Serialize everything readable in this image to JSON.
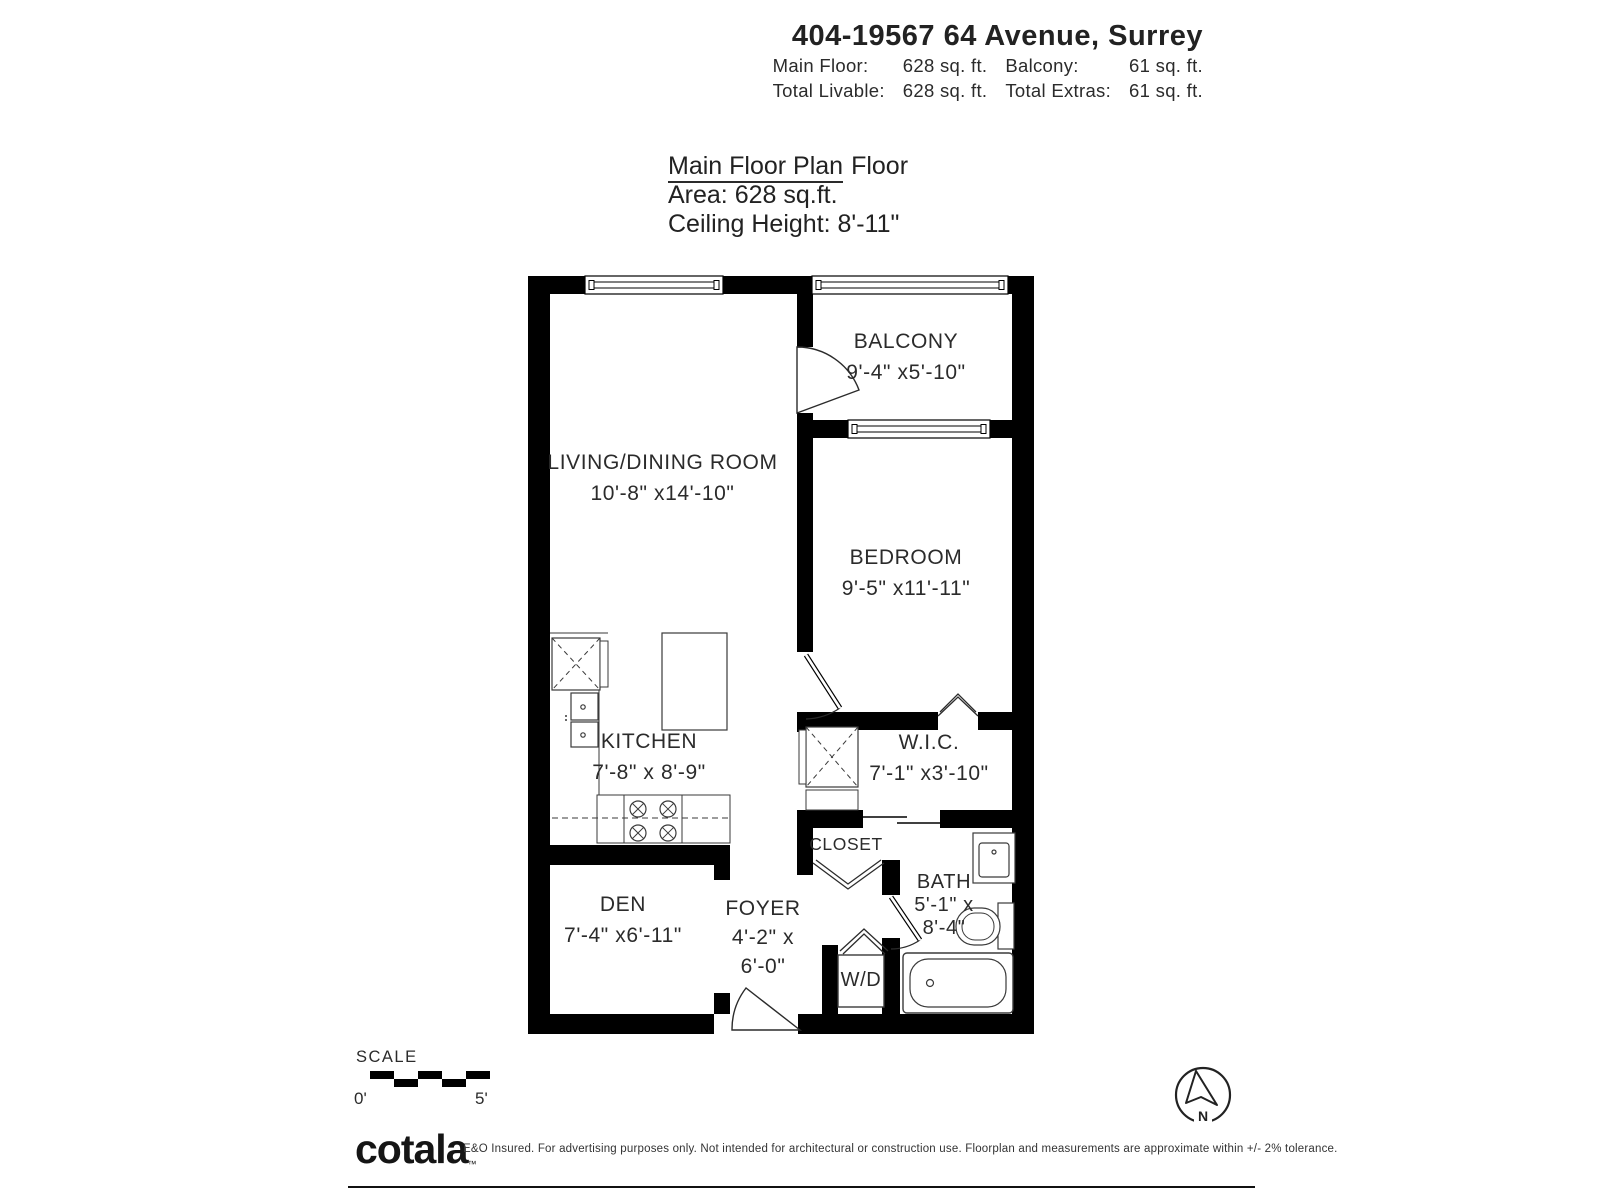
{
  "header": {
    "title": "404-19567 64 Avenue, Surrey",
    "stats_rows": [
      {
        "l1": "Main Floor:",
        "v1": "628 sq. ft.",
        "l2": "Balcony:",
        "v2": "61 sq. ft."
      },
      {
        "l1": "Total Livable:",
        "v1": "628 sq. ft.",
        "l2": "Total Extras:",
        "v2": "61 sq. ft."
      }
    ]
  },
  "plan_title": {
    "heading_underlined": "Main Floor Plan",
    "heading_rest": "Floor",
    "area": "Area: 628 sq.ft.",
    "ceiling": "Ceiling Height: 8'-11\""
  },
  "rooms": {
    "living": {
      "name": "LIVING/DINING ROOM",
      "dims": "10'-8\" x14'-10\""
    },
    "balcony": {
      "name": "BALCONY",
      "dims": "9'-4\" x5'-10\""
    },
    "bedroom": {
      "name": "BEDROOM",
      "dims": "9'-5\" x11'-11\""
    },
    "kitchen": {
      "name": "KITCHEN",
      "dims": "7'-8\" x 8'-9\""
    },
    "wic": {
      "name": "W.I.C.",
      "dims": "7'-1\" x3'-10\""
    },
    "closet": {
      "name": "CLOSET"
    },
    "bath": {
      "name": "BATH",
      "dims_line1": "5'-1\" x",
      "dims_line2": "8'-4\""
    },
    "den": {
      "name": "DEN",
      "dims": "7'-4\" x6'-11\""
    },
    "foyer": {
      "name": "FOYER",
      "dims_line1": "4'-2\" x",
      "dims_line2": "6'-0\""
    },
    "laundry": {
      "name": "W/D"
    }
  },
  "scale": {
    "label": "SCALE",
    "start": "0'",
    "end": "5'"
  },
  "compass": {
    "north": "N"
  },
  "footer": {
    "brand": "cotala",
    "trademark": "™",
    "disclaimer": "E&O Insured. For advertising purposes only. Not intended for architectural or construction use. Floorplan and measurements are approximate within +/- 2% tolerance."
  },
  "colors": {
    "wall": "#000000",
    "fixture_line": "#3a3a3a",
    "text": "#2b2b2b"
  }
}
